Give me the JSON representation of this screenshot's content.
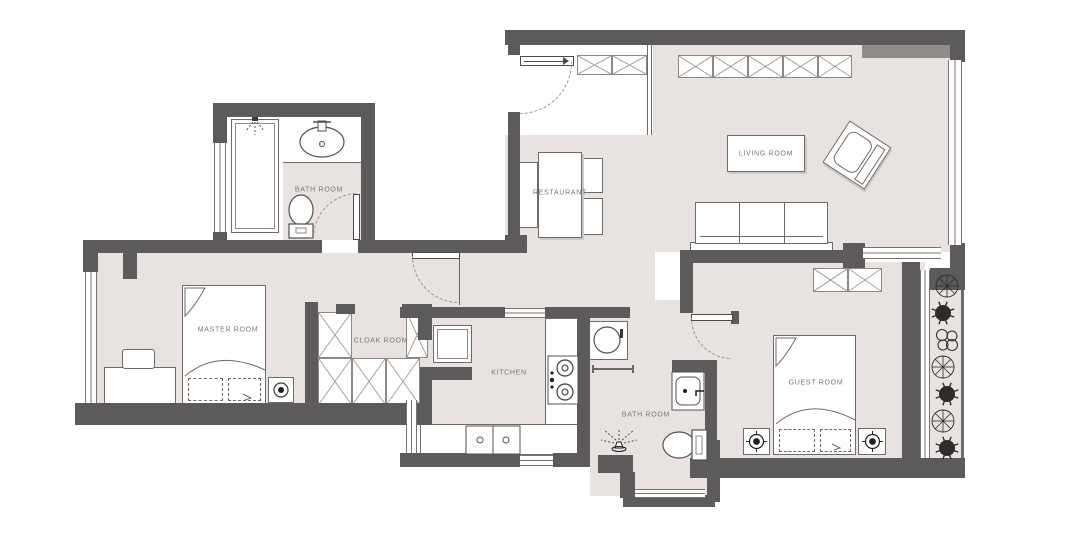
{
  "title": "Apartment floor plan",
  "colors": {
    "wall": "#5c5a5b",
    "floor": "#e8e2e0",
    "line": "#6e6a68",
    "hatch": "#aaa49f",
    "label_text": "#7b7673"
  },
  "rooms": [
    {
      "id": "bathroom-1",
      "label": "BATH ROOM"
    },
    {
      "id": "master-room",
      "label": "MASTER ROOM"
    },
    {
      "id": "cloak-room",
      "label": "CLOAK ROOM"
    },
    {
      "id": "kitchen",
      "label": "KITCHEN"
    },
    {
      "id": "restaurant",
      "label": "RESTAURANT"
    },
    {
      "id": "living-room",
      "label": "LIVING ROOM"
    },
    {
      "id": "guest-room",
      "label": "GUEST ROOM"
    },
    {
      "id": "bathroom-2",
      "label": "BATH ROOM"
    }
  ],
  "fixtures": [
    "shower-tub",
    "vanity-sink",
    "toilet",
    "bed",
    "pillow",
    "nightstand-lamp",
    "desk",
    "chair",
    "wardrobe-hatch",
    "fridge",
    "stove",
    "kitchen-sink",
    "dining-table",
    "dining-chairs",
    "sofa",
    "armchair",
    "coffee-table",
    "washing-machine",
    "towel-bar",
    "floor-drain-shower",
    "entry-door",
    "interior-door",
    "window",
    "plants"
  ],
  "balcony": {
    "plant_count": 7
  }
}
